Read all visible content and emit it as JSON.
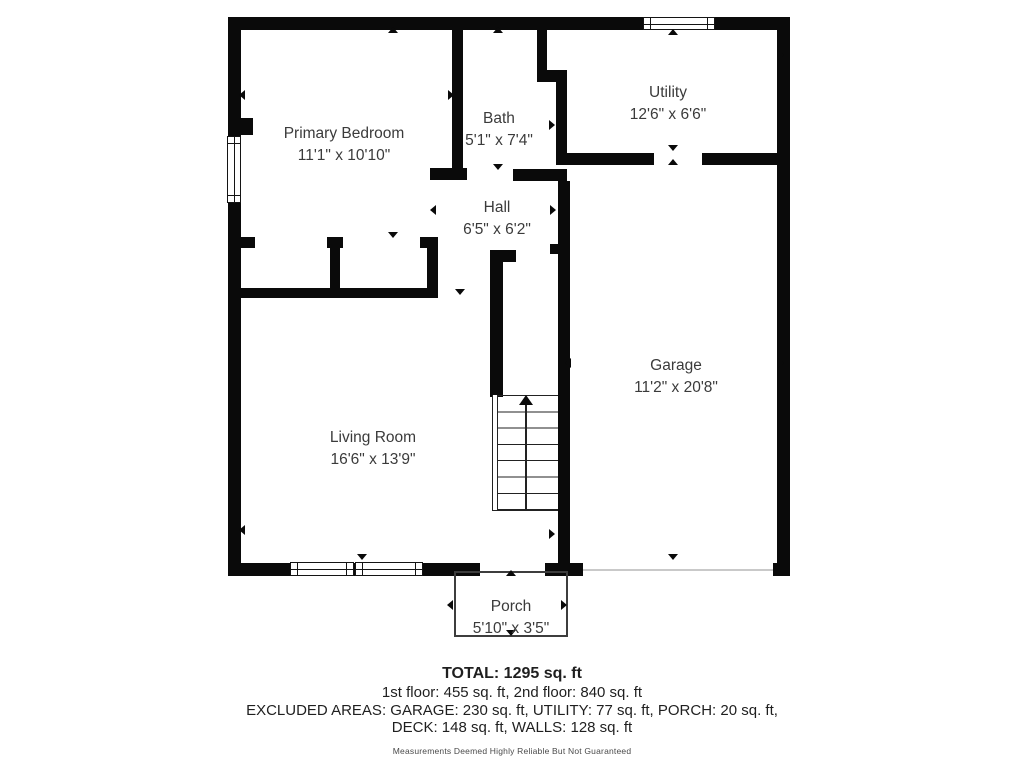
{
  "rooms": [
    {
      "name": "Primary Bedroom",
      "dims": "11'1\" x 10'10\""
    },
    {
      "name": "Bath",
      "dims": "5'1\" x 7'4\""
    },
    {
      "name": "Utility",
      "dims": "12'6\" x 6'6\""
    },
    {
      "name": "Hall",
      "dims": "6'5\" x 6'2\""
    },
    {
      "name": "Garage",
      "dims": "11'2\" x 20'8\""
    },
    {
      "name": "Living Room",
      "dims": "16'6\" x 13'9\""
    },
    {
      "name": "Porch",
      "dims": "5'10\" x 3'5\""
    }
  ],
  "summary": {
    "total": "TOTAL: 1295 sq. ft",
    "floors": "1st floor: 455 sq. ft, 2nd floor: 840 sq. ft",
    "excluded_line1": "EXCLUDED AREAS: GARAGE: 230 sq. ft, UTILITY: 77 sq. ft, PORCH: 20 sq. ft,",
    "excluded_line2": "DECK: 148 sq. ft, WALLS: 128 sq. ft",
    "disclaimer": "Measurements Deemed Highly Reliable But Not Guaranteed"
  },
  "colors": {
    "wall": "#0a0a0a",
    "label_text": "#3b3b3b"
  }
}
